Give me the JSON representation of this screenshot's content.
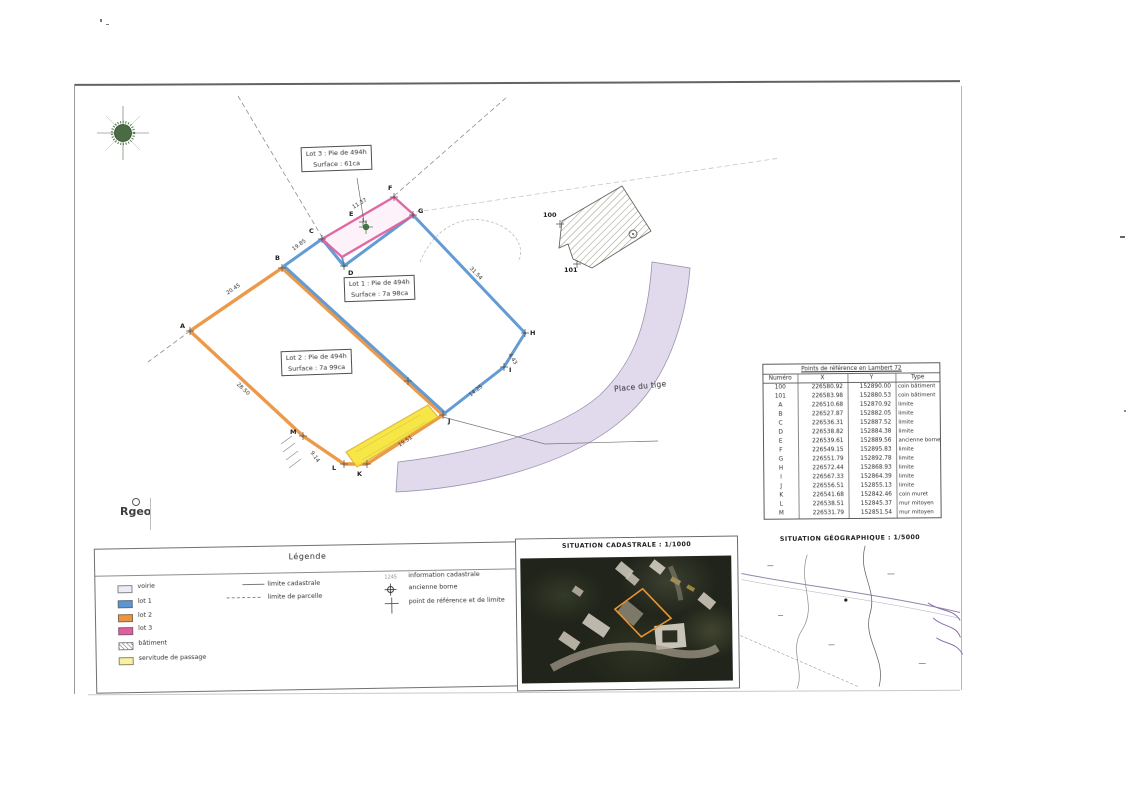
{
  "plan": {
    "lots": [
      {
        "id": "lot-3",
        "line1": "Lot 3 : Pie de 494h",
        "line2": "Surface : 61ca"
      },
      {
        "id": "lot-1",
        "line1": "Lot 1 : Pie de 494h",
        "line2": "Surface : 7a 98ca"
      },
      {
        "id": "lot-2",
        "line1": "Lot 2 : Pie de 494h",
        "line2": "Surface : 7a 99ca"
      }
    ],
    "road_label": "Place du tige",
    "logo_text": "Rgeo",
    "point_labels": [
      "A",
      "B",
      "C",
      "D",
      "E",
      "F",
      "G",
      "H",
      "I",
      "J",
      "K",
      "L",
      "M",
      "100",
      "101"
    ],
    "dimensions": [
      "20.45",
      "19.85",
      "11.37",
      "31.54",
      "4.43",
      "14.25",
      "19.51",
      "9.14",
      "28.50"
    ],
    "symbols": {
      "north": "compass-rose",
      "ancienne_borne": "circle-cross",
      "reference_point": "cross"
    },
    "colors": {
      "lot1": "#5b96d2",
      "lot2": "#ec9440",
      "lot3": "#e0609f",
      "servitude": "#f6e63e",
      "road": "#ded7ec",
      "compass_green": "#4a6b44"
    }
  },
  "reference_table": {
    "title": "Points de référence en Lambert 72",
    "columns": [
      "Numéro",
      "X",
      "Y",
      "Type"
    ],
    "rows": [
      [
        "100",
        "226580.92",
        "152890.00",
        "coin bâtiment"
      ],
      [
        "101",
        "226583.98",
        "152880.53",
        "coin bâtiment"
      ],
      [
        "A",
        "226510.68",
        "152870.92",
        "limite"
      ],
      [
        "B",
        "226527.87",
        "152882.05",
        "limite"
      ],
      [
        "C",
        "226536.31",
        "152887.52",
        "limite"
      ],
      [
        "D",
        "226538.82",
        "152884.38",
        "limite"
      ],
      [
        "E",
        "226539.61",
        "152889.56",
        "ancienne borne"
      ],
      [
        "F",
        "226549.15",
        "152895.83",
        "limite"
      ],
      [
        "G",
        "226551.79",
        "152892.78",
        "limite"
      ],
      [
        "H",
        "226572.44",
        "152868.93",
        "limite"
      ],
      [
        "I",
        "226567.33",
        "152864.39",
        "limite"
      ],
      [
        "J",
        "226556.51",
        "152855.13",
        "limite"
      ],
      [
        "K",
        "226541.68",
        "152842.46",
        "coin muret"
      ],
      [
        "L",
        "226538.51",
        "152845.37",
        "mur mitoyen"
      ],
      [
        "M",
        "226531.79",
        "152851.54",
        "mur mitoyen"
      ]
    ]
  },
  "legend": {
    "title": "Légende",
    "swatch_items": [
      {
        "label": "voirie",
        "swatch": "road"
      },
      {
        "label": "lot 1",
        "swatch": "lot1"
      },
      {
        "label": "lot 2",
        "swatch": "lot2"
      },
      {
        "label": "lot 3",
        "swatch": "lot3"
      },
      {
        "label": "bâtiment",
        "swatch": "hatch"
      },
      {
        "label": "servitude de passage",
        "swatch": "servitude"
      }
    ],
    "line_items": [
      {
        "label": "limite cadastrale",
        "style": "solid"
      },
      {
        "label": "limite de parcelle",
        "style": "dashed"
      }
    ],
    "symbol_items": [
      {
        "label": "information cadastrale",
        "symbol": "1245",
        "kind": "text"
      },
      {
        "label": "ancienne borne",
        "kind": "circle-cross"
      },
      {
        "label": "point de référence et de limite",
        "kind": "cross"
      }
    ]
  },
  "panels": {
    "cadastrale_title": "SITUATION CADASTRALE : 1/1000",
    "geographique_title": "SITUATION GÉOGRAPHIQUE : 1/5000"
  }
}
